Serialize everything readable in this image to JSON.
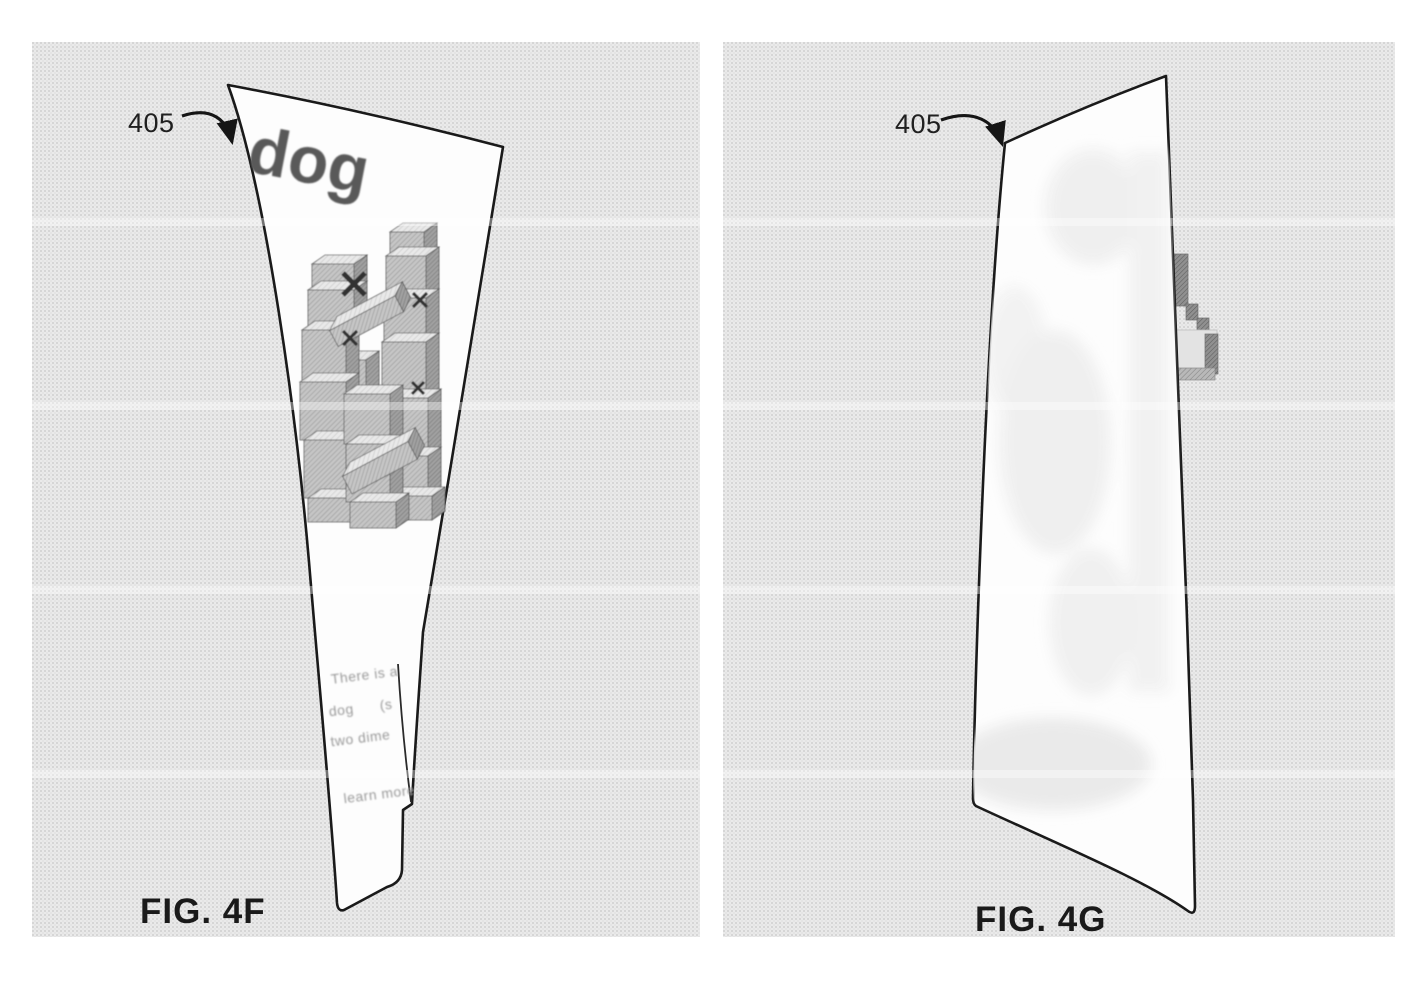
{
  "figures": {
    "left": {
      "fig_label": "FIG. 4F",
      "ref_label": "405",
      "sheet_text": "dog",
      "snippet": [
        "There is a",
        "dog      (s",
        "two dime",
        "learn more"
      ]
    },
    "right": {
      "fig_label": "FIG. 4G",
      "ref_label": "405"
    }
  },
  "colors": {
    "panel_bg": "#eaeaea",
    "ink": "#1a1a1a",
    "sheet_fill": "#fdfdfd",
    "title_gray": "#595959",
    "snippet_gray": "#9a9a9a",
    "voxel_mid": "#c6c6c6",
    "voxel_dark": "#a2a2a2",
    "voxel_light": "#e9e9e9"
  }
}
